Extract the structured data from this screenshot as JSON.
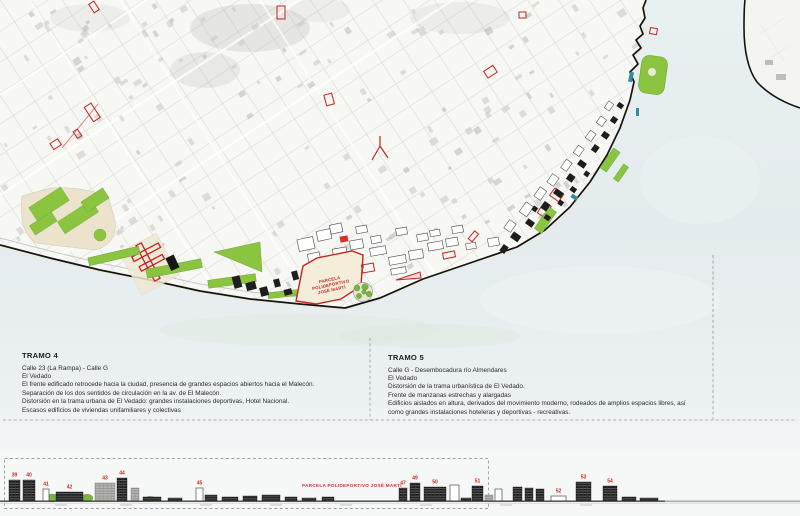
{
  "map": {
    "parcela_label_lines": [
      "PARCELA",
      "POLIDEPORTIVO",
      "JOSÉ MARTÍ"
    ],
    "colors": {
      "water": "#e4ebee",
      "land": "#f7f7f4",
      "park_green": "#8bc53f",
      "highlight_red": "#c4251f",
      "building_dark": "#1c1c1c",
      "beige": "#ece3cc",
      "coastline": "#131313"
    }
  },
  "sections": [
    {
      "id": "tramo-4",
      "heading": "TRAMO 4",
      "lines": [
        "Calle 23 (La Rampa) - Calle G",
        "El Vedado",
        "El frente edificado retrocede hacia la ciudad, presencia de grandes espacios abiertos hacia el Malecón.",
        "Separación de los dos sentidos de circulación en la av. de El Malecón.",
        "Distorsión en la trama urbana de El Vedado: grandes instalaciones deportivas, Hotel Nacional.",
        "Escasos edificios de viviendas unifamiliares y colectivas"
      ]
    },
    {
      "id": "tramo-5",
      "heading": "TRAMO 5",
      "lines": [
        "Calle G -  Desembocadura río Almendares",
        "El Vedado",
        "Distorsión de la trama urbanística de El Vedado.",
        "Frente de manzanas estrechas y alargadas",
        "Edificios aislados en altura, derivados del movimiento moderno, rodeados de amplios espacios libres, así",
        "como grandes instalaciones hoteleras y deportivas - recreativas."
      ]
    }
  ],
  "elevation": {
    "parcela_label": "PARCELA POLIDEPORTIVO JOSÉ MARTÍ",
    "ground_y": 501,
    "buildings": [
      {
        "num": "39",
        "x": 9,
        "w": 11,
        "h": 21,
        "style": "dark"
      },
      {
        "num": "40",
        "x": 23,
        "w": 12,
        "h": 21,
        "style": "dark"
      },
      {
        "num": "41",
        "x": 43,
        "w": 6,
        "h": 12,
        "style": "outline"
      },
      {
        "num": "42",
        "x": 56,
        "w": 27,
        "h": 9,
        "style": "dark"
      },
      {
        "num": "43",
        "x": 95,
        "w": 20,
        "h": 18,
        "style": "gray"
      },
      {
        "num": "44",
        "x": 117,
        "w": 10,
        "h": 23,
        "style": "dark"
      },
      {
        "num": "",
        "x": 131,
        "w": 8,
        "h": 13,
        "style": "gray"
      },
      {
        "num": "",
        "x": 143,
        "w": 18,
        "h": 4,
        "style": "dark"
      },
      {
        "num": "",
        "x": 168,
        "w": 14,
        "h": 3,
        "style": "dark"
      },
      {
        "num": "45",
        "x": 196,
        "w": 7,
        "h": 13,
        "style": "outline"
      },
      {
        "num": "",
        "x": 205,
        "w": 12,
        "h": 6,
        "style": "dark"
      },
      {
        "num": "",
        "x": 222,
        "w": 16,
        "h": 4,
        "style": "dark"
      },
      {
        "num": "",
        "x": 243,
        "w": 14,
        "h": 5,
        "style": "dark"
      },
      {
        "num": "",
        "x": 262,
        "w": 18,
        "h": 6,
        "style": "dark"
      },
      {
        "num": "",
        "x": 285,
        "w": 12,
        "h": 4,
        "style": "dark"
      },
      {
        "num": "",
        "x": 302,
        "w": 14,
        "h": 3,
        "style": "dark"
      },
      {
        "num": "",
        "x": 322,
        "w": 12,
        "h": 4,
        "style": "dark"
      },
      {
        "num": "47",
        "x": 399,
        "w": 8,
        "h": 13,
        "style": "dark"
      },
      {
        "num": "49",
        "x": 410,
        "w": 10,
        "h": 18,
        "style": "dark"
      },
      {
        "num": "50",
        "x": 424,
        "w": 22,
        "h": 14,
        "style": "dark"
      },
      {
        "num": "",
        "x": 450,
        "w": 9,
        "h": 16,
        "style": "outline"
      },
      {
        "num": "",
        "x": 461,
        "w": 10,
        "h": 3,
        "style": "dark"
      },
      {
        "num": "51",
        "x": 472,
        "w": 11,
        "h": 15,
        "style": "dark"
      },
      {
        "num": "",
        "x": 485,
        "w": 8,
        "h": 6,
        "style": "gray"
      },
      {
        "num": "",
        "x": 495,
        "w": 7,
        "h": 12,
        "style": "outline"
      },
      {
        "num": "",
        "x": 513,
        "w": 9,
        "h": 14,
        "style": "dark"
      },
      {
        "num": "",
        "x": 525,
        "w": 8,
        "h": 13,
        "style": "dark"
      },
      {
        "num": "",
        "x": 536,
        "w": 8,
        "h": 12,
        "style": "dark"
      },
      {
        "num": "52",
        "x": 551,
        "w": 15,
        "h": 5,
        "style": "outline"
      },
      {
        "num": "53",
        "x": 576,
        "w": 15,
        "h": 19,
        "style": "dark"
      },
      {
        "num": "54",
        "x": 603,
        "w": 14,
        "h": 15,
        "style": "dark"
      },
      {
        "num": "",
        "x": 622,
        "w": 14,
        "h": 4,
        "style": "dark"
      },
      {
        "num": "",
        "x": 640,
        "w": 18,
        "h": 3,
        "style": "dark"
      }
    ]
  }
}
